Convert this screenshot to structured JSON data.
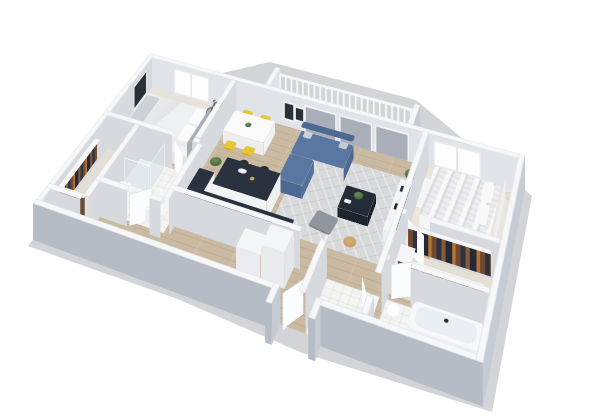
{
  "canvas": {
    "width": 600,
    "height": 420
  },
  "image_type": "3d-isometric-floor-plan-render",
  "description": "Rendered 3D cutaway floor plan of a two-bedroom apartment viewed from above at an angle, on a plain white background",
  "palette": {
    "bg": "#ffffff",
    "wood": "#cbbaa2",
    "wood-seam": "rgba(125,100,75,0.22)",
    "carpet": "#e8e3d9",
    "carpet2": "#eae6dc",
    "tile": "#f3f4f2",
    "balcony-floor": "#c4c8ce",
    "wall-top": "#f6f7f9",
    "wall-face": "#d6dade",
    "wall-face-light": "#e0e3e7",
    "wall-outer": "#b6bcc6",
    "wall-outer-light": "#c6ccd4",
    "sofa": "#5a77a1",
    "sofa-dark": "#4d6992",
    "rug": "#d8d9db",
    "counter-navy": "#2a323f",
    "counter-dark": "#1b212b",
    "chair-yellow": "#e8c533",
    "white-furn": "#f4f5f7",
    "green": "#5d7f4b",
    "green-dark": "#49663c",
    "tv": "#191d23",
    "ottoman": "#90959d",
    "basket": "#c79a5d",
    "wood-brown": "#5b4837",
    "glass-door": "#a9aeb8",
    "art": "#2c3137",
    "shadow": "rgba(108,114,126,0.30)",
    "clothes-a": "#6f4a2e",
    "clothes-b": "#2c3146",
    "clothes-c": "#b8752f"
  },
  "scene": {
    "rooms": [
      {
        "id": "bedroom-left",
        "floor": "carpet",
        "items": [
          "double-bed",
          "nightstands",
          "table-lamps",
          "wall-art",
          "bicycle",
          "window"
        ]
      },
      {
        "id": "bathroom-left",
        "floor": "tile",
        "items": [
          "walk-in-shower",
          "toilet",
          "vanity-sink"
        ]
      },
      {
        "id": "closet-left",
        "floor": "carpet",
        "items": [
          "hanging-clothes",
          "wire-shelf"
        ]
      },
      {
        "id": "dining-area",
        "floor": "wood",
        "items": [
          "white-dining-table",
          "four-yellow-chairs",
          "potted-plant"
        ]
      },
      {
        "id": "kitchen",
        "floor": "wood",
        "items": [
          "navy-top-island",
          "two-bar-stools",
          "navy-counters",
          "sink",
          "refrigerator",
          "appliance"
        ]
      },
      {
        "id": "living-room",
        "floor": "wood",
        "items": [
          "blue-sectional-sofa",
          "area-rug",
          "navy-coffee-table",
          "gray-ottoman",
          "basket",
          "tv-console",
          "tv",
          "wall-frames",
          "floor-plant"
        ]
      },
      {
        "id": "balcony",
        "floor": "concrete-panels",
        "items": [
          "white-railing",
          "parapet-walls",
          "planter"
        ]
      },
      {
        "id": "bedroom-right",
        "floor": "carpet",
        "items": [
          "double-bed",
          "headboard",
          "foot-bench",
          "floor-lamp",
          "dresser",
          "window"
        ]
      },
      {
        "id": "closet-right",
        "floor": "carpet",
        "items": [
          "hanging-clothes-two-rails",
          "shelves",
          "dresser"
        ]
      },
      {
        "id": "bathroom-right",
        "floor": "tile",
        "items": [
          "bathtub",
          "toilet"
        ]
      },
      {
        "id": "hallway",
        "floor": "wood",
        "items": [
          "entry-door",
          "interior-doors",
          "door-jamb-stubs"
        ]
      }
    ]
  }
}
